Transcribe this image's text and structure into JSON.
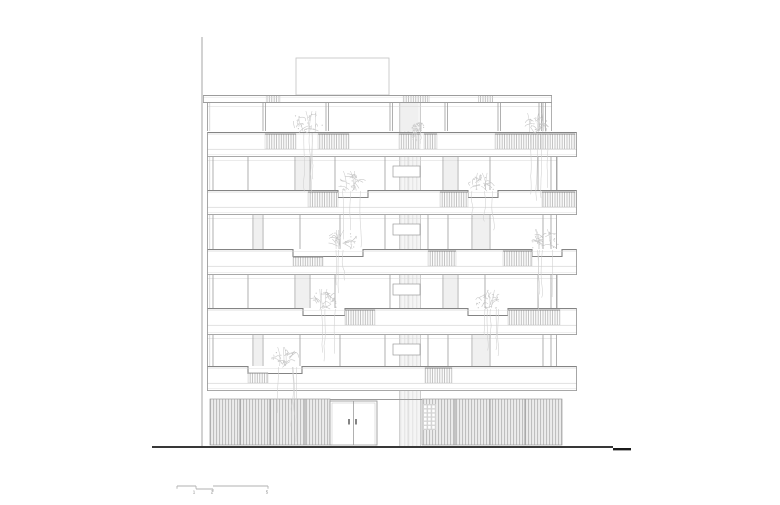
{
  "canvas": {
    "width": 780,
    "height": 505,
    "bg": "#ffffff"
  },
  "palette": {
    "line_faint": "#d8d8d8",
    "line_light": "#c2c2c2",
    "line_mid": "#9c9c9c",
    "line_dark": "#848484",
    "hatch": "#adadad",
    "hatch_bg": "#fbfbfb",
    "louver": "#b6b6b6",
    "louver_bg": "#ececec",
    "core_bg": "#f3f3f3",
    "core_line": "#e3e3e3",
    "plant": "#c7c7c7",
    "plant_strand": "#cfcfcf",
    "ground": "#1b1b1b",
    "panel_bg": "#d4d4d4",
    "label": "#8a8a8a"
  },
  "site": {
    "section_line": {
      "x": 202,
      "y1": 37,
      "y2": 446
    },
    "ground_line": {
      "x1": 152,
      "x2": 613,
      "y": 447,
      "w": 1.8
    },
    "ground_line_end": {
      "x1": 613,
      "x2": 631,
      "y": 449.2,
      "w": 2.4
    }
  },
  "building": {
    "rooftop_box": {
      "x1": 296,
      "x2": 389,
      "y1": 58,
      "y2": 95
    },
    "roof_band": {
      "x1": 203,
      "x2": 552,
      "y": 95,
      "h": 8,
      "rails": [
        [
          265,
          281
        ],
        [
          402,
          430
        ],
        [
          478,
          493
        ]
      ]
    },
    "core": {
      "x1": 399,
      "x2": 421,
      "y1": 103,
      "y2": 446,
      "mid": 408
    },
    "zones": [
      {
        "y1": 103,
        "y2": 131,
        "x1": 207,
        "x2": 552,
        "double": true,
        "box": false,
        "mullions": [
          263,
          326,
          390,
          445,
          498,
          539,
          543
        ],
        "strips": [
          [
            402,
            418
          ]
        ]
      },
      {
        "y1": 157,
        "y2": 190,
        "x1": 207,
        "x2": 557,
        "double": false,
        "box": true,
        "mullions": [
          213,
          248,
          295,
          310,
          335,
          385,
          443,
          458,
          490,
          538,
          551,
          557
        ],
        "strips": [
          [
            296,
            309
          ],
          [
            444,
            457
          ]
        ]
      },
      {
        "y1": 215,
        "y2": 249,
        "x1": 207,
        "x2": 557,
        "double": false,
        "box": true,
        "mullions": [
          213,
          253,
          263,
          300,
          340,
          385,
          428,
          448,
          472,
          490,
          543,
          551
        ],
        "strips": [
          [
            254,
            262
          ],
          [
            473,
            489
          ]
        ]
      },
      {
        "y1": 275,
        "y2": 308,
        "x1": 207,
        "x2": 557,
        "double": false,
        "box": true,
        "mullions": [
          213,
          248,
          295,
          310,
          335,
          390,
          443,
          458,
          485,
          538,
          551,
          557
        ],
        "strips": [
          [
            296,
            309
          ],
          [
            444,
            457
          ]
        ]
      },
      {
        "y1": 335,
        "y2": 366,
        "x1": 207,
        "x2": 557,
        "double": false,
        "box": true,
        "mullions": [
          213,
          253,
          263,
          300,
          340,
          385,
          428,
          448,
          472,
          490,
          543,
          551
        ],
        "strips": [
          [
            254,
            262
          ],
          [
            473,
            489
          ]
        ]
      }
    ],
    "bands": [
      {
        "y": 132,
        "h": 25,
        "x1": 207,
        "x2": 577,
        "rails": [
          [
            265,
            296,
            0
          ],
          [
            318,
            349,
            0
          ],
          [
            399,
            420,
            0
          ],
          [
            424,
            437,
            0
          ],
          [
            495,
            575,
            0
          ]
        ],
        "notches": []
      },
      {
        "y": 190,
        "h": 25,
        "x1": 207,
        "x2": 577,
        "rails": [
          [
            308,
            338,
            0
          ],
          [
            440,
            468,
            0
          ],
          [
            542,
            575,
            0
          ]
        ],
        "notches": [
          [
            338,
            368
          ],
          [
            468,
            498
          ]
        ]
      },
      {
        "y": 249,
        "h": 26,
        "x1": 207,
        "x2": 577,
        "rails": [
          [
            293,
            323,
            6
          ],
          [
            428,
            456,
            0
          ],
          [
            503,
            532,
            0
          ]
        ],
        "notches": [
          [
            293,
            363
          ],
          [
            532,
            562
          ]
        ]
      },
      {
        "y": 308,
        "h": 27,
        "x1": 207,
        "x2": 577,
        "rails": [
          [
            345,
            375,
            0
          ],
          [
            508,
            560,
            0
          ]
        ],
        "notches": [
          [
            303,
            345
          ],
          [
            468,
            508
          ]
        ]
      },
      {
        "y": 366,
        "h": 25,
        "x1": 207,
        "x2": 577,
        "rails": [
          [
            248,
            268,
            5
          ],
          [
            425,
            452,
            0
          ]
        ],
        "notches": [
          [
            248,
            302
          ]
        ]
      }
    ],
    "ground_floor": {
      "lintel_y": 399.5,
      "louver_left": {
        "x1": 210,
        "x2": 330,
        "y1": 399,
        "y2": 445,
        "joints": [
          240,
          270,
          305
        ]
      },
      "door": {
        "x1": 330,
        "x2": 377,
        "y1": 401,
        "y2": 445,
        "stile": 353.5,
        "handles": [
          [
            348,
            419
          ],
          [
            355,
            419
          ]
        ]
      },
      "louver_right": {
        "x1": 422,
        "x2": 562,
        "y1": 399,
        "y2": 445,
        "joints": [
          455,
          490,
          525
        ]
      },
      "perf_panel": {
        "x": 423,
        "y": 404,
        "w": 13,
        "h": 26,
        "cols": 3,
        "rows": 6
      }
    },
    "plants": [
      {
        "x": 308,
        "y": 132,
        "s": 1.1,
        "hang": 58,
        "seed": 11
      },
      {
        "x": 536,
        "y": 132,
        "s": 1.0,
        "hang": 72,
        "seed": 22
      },
      {
        "x": 418,
        "y": 131,
        "s": 0.45,
        "hang": 12,
        "seed": 33
      },
      {
        "x": 352,
        "y": 190,
        "s": 1.0,
        "hang": 58,
        "seed": 44
      },
      {
        "x": 482,
        "y": 190,
        "s": 0.9,
        "hang": 42,
        "seed": 55
      },
      {
        "x": 343,
        "y": 249,
        "s": 1.0,
        "hang": 55,
        "seed": 66
      },
      {
        "x": 546,
        "y": 249,
        "s": 1.05,
        "hang": 80,
        "seed": 77
      },
      {
        "x": 324,
        "y": 308,
        "s": 1.0,
        "hang": 52,
        "seed": 88
      },
      {
        "x": 488,
        "y": 308,
        "s": 0.95,
        "hang": 46,
        "seed": 99
      },
      {
        "x": 285,
        "y": 366,
        "s": 1.0,
        "hang": 72,
        "seed": 111
      }
    ]
  },
  "scale_bar": {
    "segments": [
      {
        "x1": 177,
        "x2": 196,
        "y": 486
      },
      {
        "x1": 196,
        "x2": 213,
        "y": 489
      },
      {
        "x1": 213,
        "x2": 268,
        "y": 486
      }
    ],
    "ticks": [
      {
        "x": 177,
        "y": 486
      },
      {
        "x": 196,
        "y": 486
      },
      {
        "x": 213,
        "y": 489
      },
      {
        "x": 268,
        "y": 486
      }
    ],
    "labels": [
      {
        "text": "1",
        "x": 194,
        "y": 493.5
      },
      {
        "text": "2",
        "x": 212,
        "y": 493.5
      },
      {
        "text": "5",
        "x": 267,
        "y": 493.5
      }
    ]
  }
}
